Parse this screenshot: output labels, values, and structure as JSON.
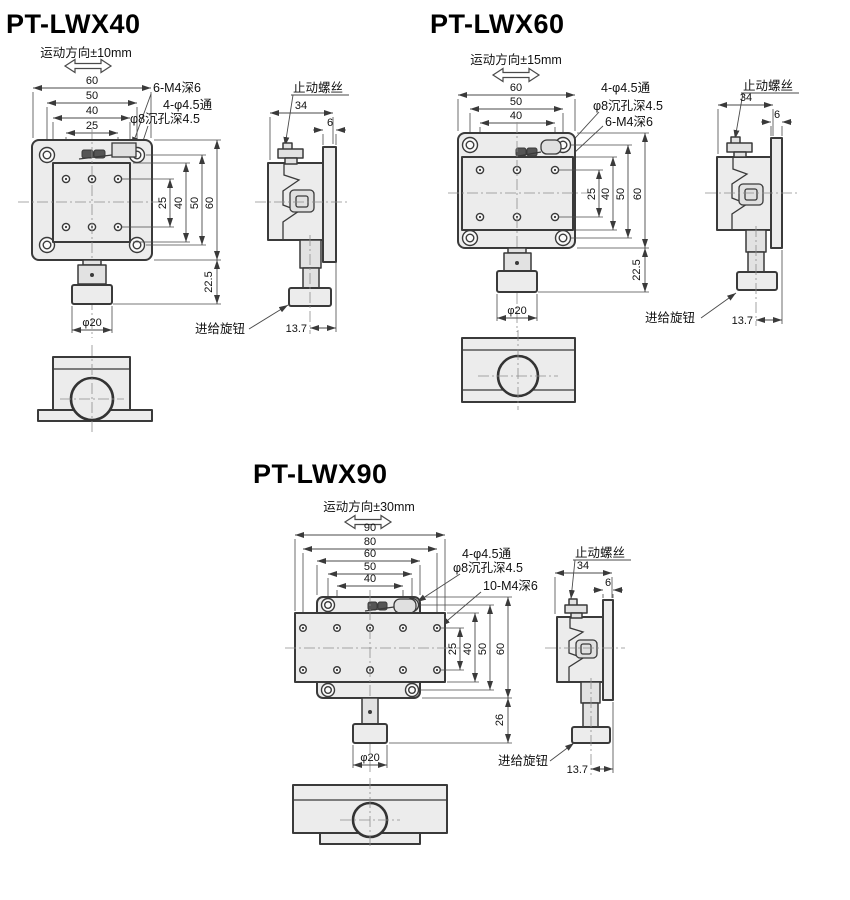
{
  "drawing": {
    "models": [
      {
        "title": "PT-LWX40",
        "travel": "运动方向±10mm",
        "top_dims": [
          "60",
          "50",
          "40",
          "25"
        ],
        "callouts": [
          "6-M4深6",
          "4-φ4.5通",
          "φ8沉孔深4.5"
        ],
        "right_dims": [
          "25",
          "40",
          "50",
          "60"
        ],
        "height_dim": "22.5",
        "knob_dia": "φ20",
        "stop_screw": "止动螺丝",
        "feed_knob": "进给旋钮",
        "side": {
          "width": "34",
          "flange": "6",
          "offset": "13.7"
        }
      },
      {
        "title": "PT-LWX60",
        "travel": "运动方向±15mm",
        "top_dims": [
          "60",
          "50",
          "40"
        ],
        "callouts": [
          "4-φ4.5通",
          "φ8沉孔深4.5",
          "6-M4深6"
        ],
        "right_dims": [
          "25",
          "40",
          "50",
          "60"
        ],
        "height_dim": "22.5",
        "knob_dia": "φ20",
        "stop_screw": "止动螺丝",
        "feed_knob": "进给旋钮",
        "side": {
          "width": "34",
          "flange": "6",
          "offset": "13.7"
        }
      },
      {
        "title": "PT-LWX90",
        "travel": "运动方向±30mm",
        "top_dims": [
          "90",
          "80",
          "60",
          "50",
          "40"
        ],
        "callouts": [
          "4-φ4.5通",
          "φ8沉孔深4.5",
          "10-M4深6"
        ],
        "right_dims": [
          "25",
          "40",
          "50",
          "60"
        ],
        "height_dim": "26",
        "knob_dia": "φ20",
        "stop_screw": "止动螺丝",
        "feed_knob": "进给旋钮",
        "side": {
          "width": "34",
          "flange": "6",
          "offset": "13.7"
        }
      }
    ]
  }
}
